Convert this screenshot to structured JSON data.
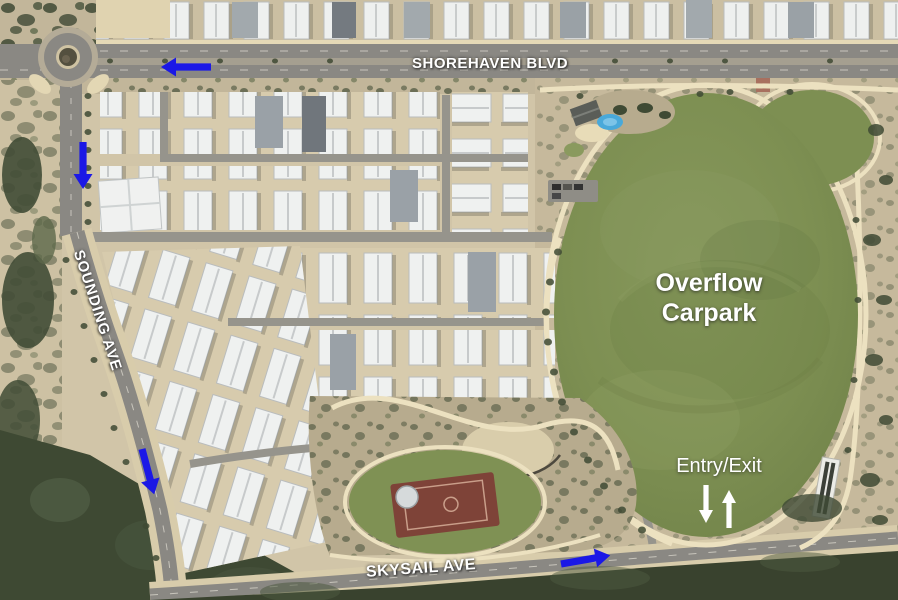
{
  "annotations": {
    "street_labels": [
      {
        "id": "shorehaven",
        "text": "SHOREHAVEN BLVD"
      },
      {
        "id": "sounding",
        "text": "SOUNDING AVE"
      },
      {
        "id": "skysail",
        "text": "SKYSAIL AVE"
      }
    ],
    "area_label": {
      "line1": "Overflow",
      "line2": "Carpark"
    },
    "entry_exit_label": "Entry/Exit",
    "route_arrows": [
      {
        "id": "shorehaven-westbound",
        "direction": "left"
      },
      {
        "id": "north-road-southbound",
        "direction": "down"
      },
      {
        "id": "sounding-southbound",
        "direction": "down-right"
      },
      {
        "id": "skysail-eastbound",
        "direction": "right"
      }
    ],
    "entry_exit_arrows": [
      {
        "id": "exit-arrow",
        "direction": "down"
      },
      {
        "id": "entry-arrow",
        "direction": "up"
      }
    ]
  },
  "colors": {
    "route_arrow_blue": "#1b18e6",
    "entry_exit_arrow_white": "#ffffff",
    "label_text_white": "#ffffff",
    "oval_green": "#7d8f52",
    "path_cream": "#ece1c0",
    "sand": "#d1c5a8",
    "road_gray": "#8a8883",
    "vegetation_dark": "#3f4a34",
    "court_red": "#7e4338",
    "splash_pad_blue": "#49a9da"
  }
}
